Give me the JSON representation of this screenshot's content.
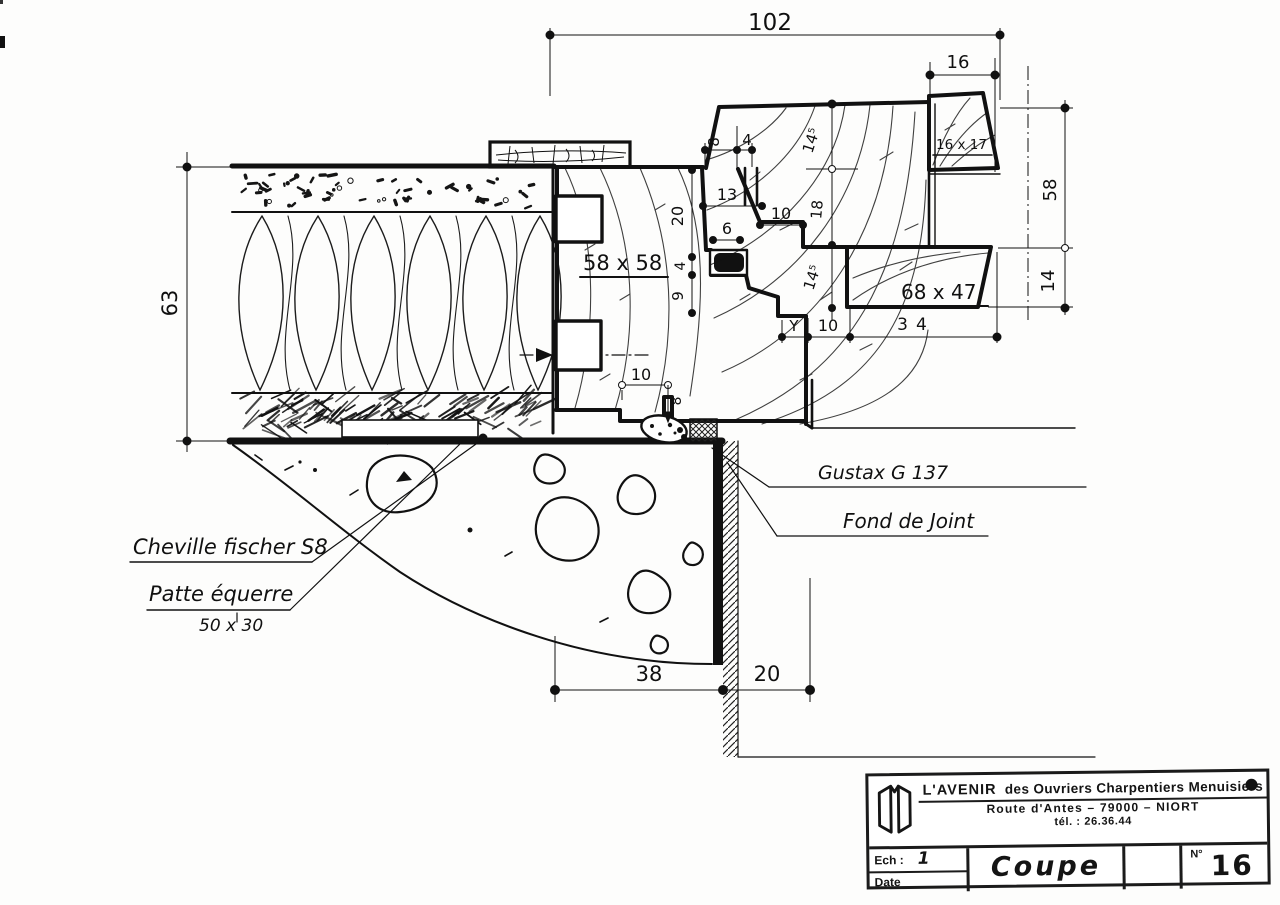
{
  "drawing": {
    "dims": {
      "overall": "102",
      "bead_w": "16",
      "right_upper": "58",
      "right_lower": "14",
      "wall": "63",
      "s8": "8",
      "s4": "4",
      "s13": "13",
      "s10a": "10",
      "s6": "6",
      "v20": "20",
      "v4": "4",
      "v9": "9",
      "d145a": "14⁵",
      "v18": "18",
      "d145b": "14⁵",
      "dY": "Y",
      "s10b": "10",
      "d34": "34",
      "s10c": "10",
      "v8": "8",
      "d38": "38",
      "d20": "20"
    },
    "labels": {
      "frame_section": "58 x 58",
      "sash_section": "68 x 47",
      "bead_section": "16 x 17",
      "sealant": "Gustax G 137",
      "joint_filler": "Fond de Joint",
      "anchor": "Cheville fischer S8",
      "bracket": "Patte équerre",
      "bracket_size": "50 x 30"
    }
  },
  "title_block": {
    "company": "L'AVENIR",
    "company_rest": "des Ouvriers Charpentiers Menuisiers",
    "address": "Route d'Antes – 79000 – NIORT",
    "phone": "tél. : 26.36.44",
    "scale_label": "Ech :",
    "scale_value": "1",
    "date_label": "Date",
    "sheet_title": "Coupe",
    "number_label": "N°",
    "number_value": "16"
  }
}
